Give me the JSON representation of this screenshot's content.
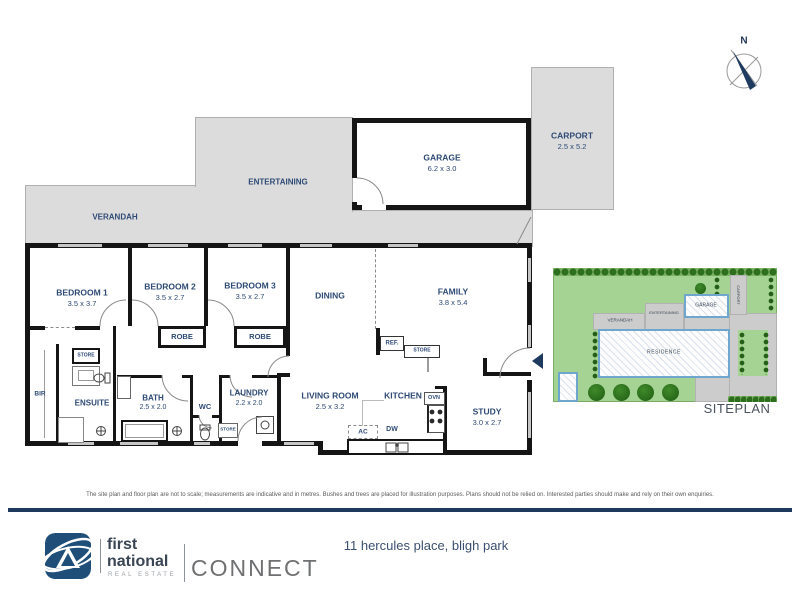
{
  "fp": {
    "compass": "N",
    "verandah": {
      "label": "VERANDAH"
    },
    "entertaining": {
      "label": "ENTERTAINING"
    },
    "garage": {
      "label": "GARAGE",
      "dims": "6.2 x 3.0"
    },
    "carport": {
      "label": "CARPORT",
      "dims": "2.5 x 5.2"
    },
    "bedroom1": {
      "label": "BEDROOM 1",
      "dims": "3.5 x 3.7"
    },
    "bedroom2": {
      "label": "BEDROOM 2",
      "dims": "3.5 x 2.7"
    },
    "bedroom3": {
      "label": "BEDROOM 3",
      "dims": "3.5 x 2.7"
    },
    "dining": {
      "label": "DINING"
    },
    "family": {
      "label": "FAMILY",
      "dims": "3.8 x 5.4"
    },
    "living": {
      "label": "LIVING ROOM",
      "dims": "2.5 x 3.2"
    },
    "kitchen": {
      "label": "KITCHEN"
    },
    "study": {
      "label": "STUDY",
      "dims": "3.0 x 2.7"
    },
    "ensuite": {
      "label": "ENSUITE"
    },
    "bath": {
      "label": "BATH",
      "dims": "2.5 x 2.0"
    },
    "wc": {
      "label": "WC"
    },
    "laundry": {
      "label": "LAUNDRY",
      "dims": "2.2 x 2.0"
    },
    "robe1": {
      "label": "ROBE"
    },
    "robe2": {
      "label": "ROBE"
    },
    "store_hall": {
      "label": "STORE"
    },
    "store_kitchen": {
      "label": "STORE"
    },
    "store_laundry": {
      "label": "STORE"
    },
    "bir": {
      "label": "BIR"
    },
    "ref": {
      "label": "REF."
    },
    "ovn": {
      "label": "OVN"
    },
    "dw": {
      "label": "DW"
    },
    "ac": {
      "label": "AC"
    }
  },
  "siteplan": {
    "title": "SITEPLAN",
    "residence": "RESIDENCE",
    "garage": "GARAGE",
    "carport": "CARPORT",
    "verandah": "VERANDAH",
    "entertaining": "ENTERTAINING"
  },
  "footer": {
    "disclaimer": "The site plan and floor plan are not to scale; measurements are indicative and in metres. Bushes and trees are placed for illustration purposes. Plans should not be relied on. Interested parties should make and rely on their own enquiries.",
    "address": "11 hercules place, bligh park",
    "brand": {
      "line1": "first",
      "line2": "national",
      "line3": "REAL ESTATE",
      "division": "CONNECT"
    }
  },
  "colors": {
    "accent_navy": "#1e3a5f",
    "label_navy": "#2e4a75",
    "wall_black": "#151515",
    "outdoor_gray": "#dcdcdc",
    "lawn_green": "#a5d394",
    "tree_green": "#1f5c12",
    "plan_blue_border": "#6fa6cd"
  }
}
